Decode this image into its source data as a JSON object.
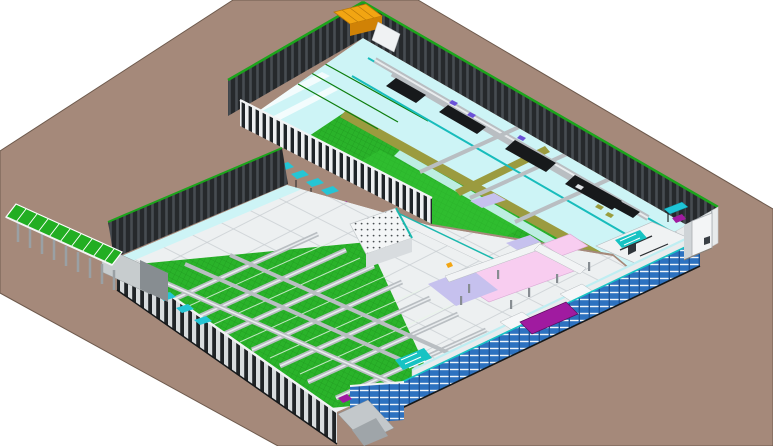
{
  "meta": {
    "title": "Isometric 3D BIM model of an industrial production facility",
    "render_type": "axonometric CAD render",
    "background": "#ffffff"
  },
  "colors": {
    "ground": "#a5897a",
    "ground_edge": "#6e5a4d",
    "wall_dark": "#26292c",
    "wall_rib": "#474c51",
    "roof_stripe_green": "#1ca41c",
    "floor_cyan": "#cdf4f6",
    "floor_green": "#2ab32a",
    "mesh_line": "#1f9a1f",
    "olive_wall": "#9b9b3f",
    "teal_pipe": "#18bcbc",
    "pipe_green": "#0d7d0d",
    "conveyor_grey": "#b9bec2",
    "conveyor_top": "#e9ecee",
    "slab_white": "#edf0f1",
    "grid_line": "#c9ced2",
    "zone_pink": "#f8cdf0",
    "zone_lavender": "#c6c1ee",
    "rack_blue": "#2d72c0",
    "rack_stripe": "#eef4f9",
    "magenta": "#a01ba0",
    "pallet_orange": "#f2a512",
    "pallet_side": "#d08206",
    "canopy_green": "#22ae22",
    "column_grey": "#9aa0a4",
    "cabinet_white": "#f3f5f6",
    "table_teal": "#1fc4d6",
    "machinery_dark": "#17191b",
    "machinery_purple": "#6a52d8",
    "bench_white": "#f2f4f5",
    "bench_lavender": "#b9b2e6",
    "walkway_white": "#e9eced",
    "stair_teal": "#17c3c3"
  },
  "scene": {
    "ground_label": "site ground plane",
    "north_hall_label": "upper production hall",
    "south_hall_label": "lower production hall",
    "canopy_label": "loading dock canopy",
    "racks_label": "pallet rack facade",
    "cabinet_label": "outdoor utility cabinet",
    "pallets_label": "orange pallet stack",
    "machine_label": "magenta platform machine"
  }
}
